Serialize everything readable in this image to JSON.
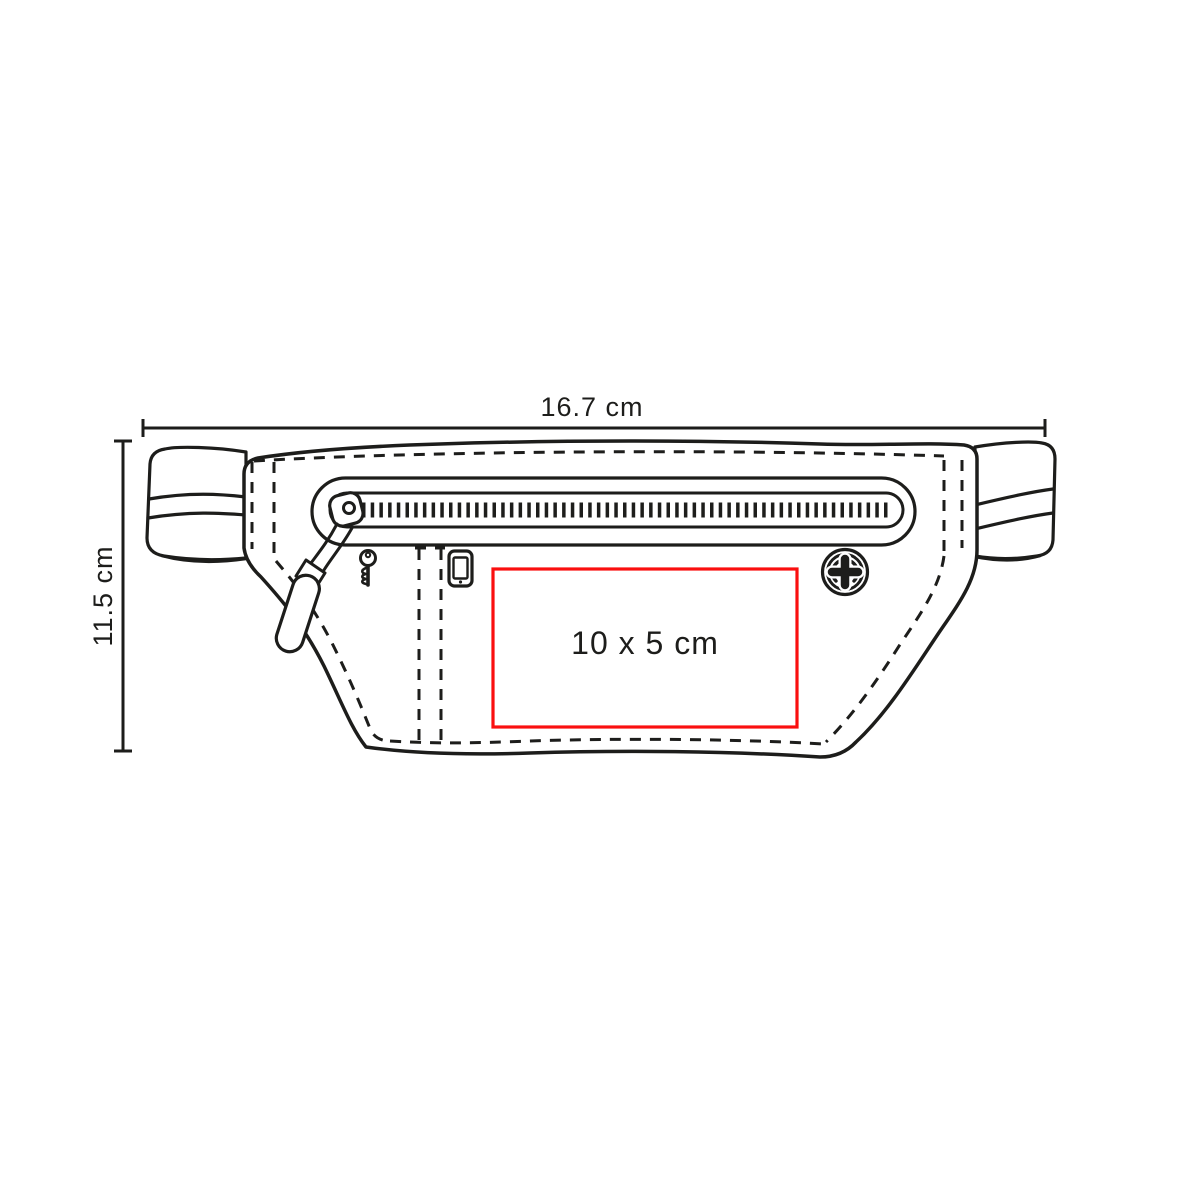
{
  "diagram": {
    "kind": "product-print-area-diagram",
    "width_dimension": {
      "label": "16.7 cm"
    },
    "height_dimension": {
      "label": "11.5 cm"
    },
    "print_area": {
      "label": "10 x 5 cm"
    }
  },
  "colors": {
    "line": "#1d1d1b",
    "print_area_border": "#fa0f0f",
    "text": "#1d1d1b",
    "background": "#ffffff"
  },
  "icons": {
    "key": "key-icon",
    "smartphone": "smartphone-icon",
    "snap_button": "snap-button-icon",
    "zipper": "zipper-icon",
    "zipper_pull": "zipper-pull-icon"
  }
}
